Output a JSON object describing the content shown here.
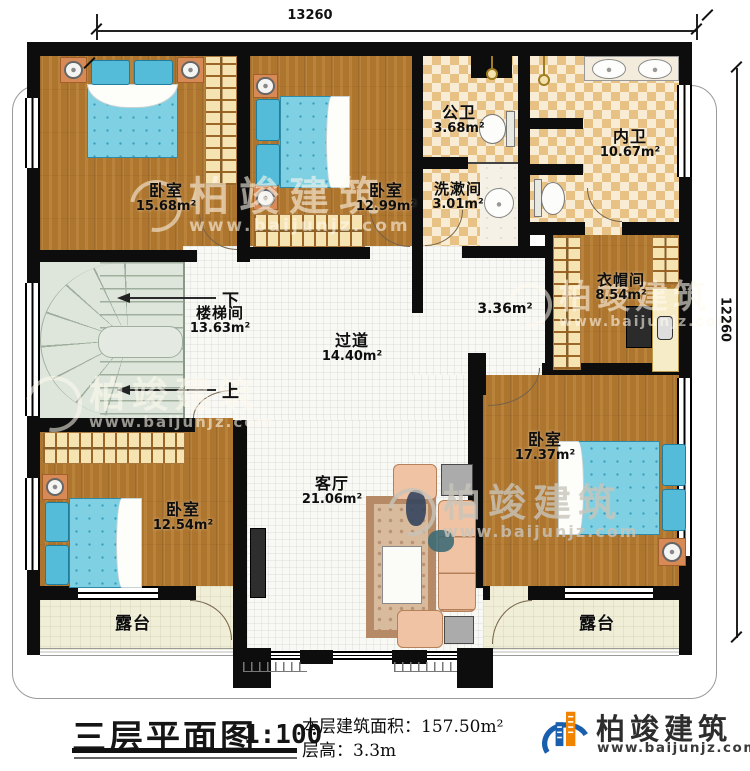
{
  "dimensions": {
    "top": "13260",
    "right": "12260"
  },
  "rooms": {
    "bedroom1": {
      "name": "卧室",
      "area": "15.68m²"
    },
    "bedroom2": {
      "name": "卧室",
      "area": "12.99m²"
    },
    "public_bath": {
      "name": "公卫",
      "area": "3.68m²"
    },
    "washroom": {
      "name": "洗漱间",
      "area": "3.01m²"
    },
    "inner_bath": {
      "name": "内卫",
      "area": "10.67m²"
    },
    "cloakroom": {
      "name": "衣帽间",
      "area": "8.54m²"
    },
    "stairwell": {
      "name": "楼梯间",
      "area": "13.63m²"
    },
    "hallway": {
      "name": "过道",
      "area": "14.40m²"
    },
    "hallway_nook": {
      "area": "3.36m²"
    },
    "living_room": {
      "name": "客厅",
      "area": "21.06m²"
    },
    "bedroom3": {
      "name": "卧室",
      "area": "12.54m²"
    },
    "bedroom4": {
      "name": "卧室",
      "area": "17.37m²"
    },
    "terrace_left": {
      "name": "露台"
    },
    "terrace_right": {
      "name": "露台"
    }
  },
  "stairs": {
    "down": "下",
    "up": "上"
  },
  "titleblock": {
    "title": "三层平面图",
    "scale": "1:100",
    "area_label": "本层建筑面积：",
    "area_value": "157.50m²",
    "floor_height_label": "层高：",
    "floor_height_value": "3.3m"
  },
  "brand": {
    "name": "柏竣建筑",
    "website": "www.baijunjz.com"
  },
  "watermark": {
    "name": "柏竣建筑",
    "website": "www.baijunjz.com"
  },
  "colors": {
    "wall": "#0d0d0d",
    "wood": "#ae752e",
    "tile": "#e8c184",
    "accent_blue": "#1a5fae",
    "accent_orange": "#f08300"
  }
}
